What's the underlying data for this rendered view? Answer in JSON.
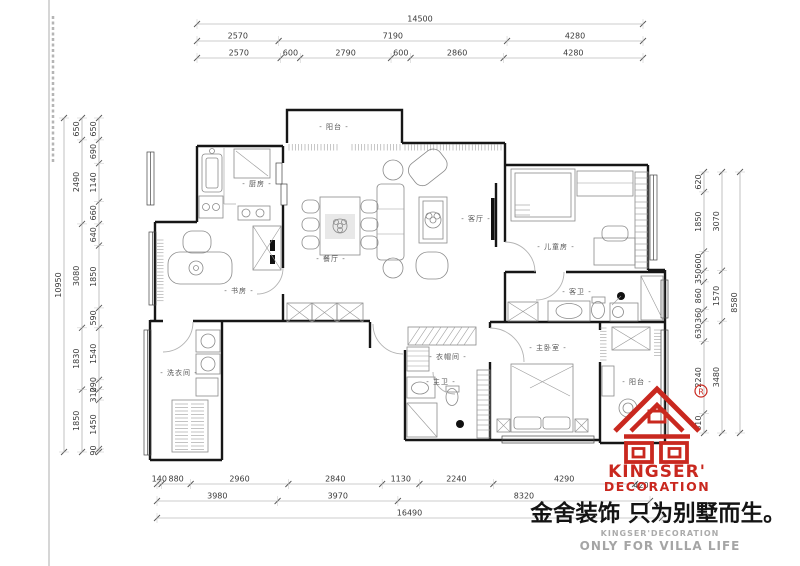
{
  "drawing": {
    "rooms": [
      {
        "label": "- 阳台 -",
        "x": 334,
        "y": 129
      },
      {
        "label": "- 厨房 -",
        "x": 257,
        "y": 186
      },
      {
        "label": "- 书房 -",
        "x": 239,
        "y": 293
      },
      {
        "label": "- 餐厅 -",
        "x": 331,
        "y": 261
      },
      {
        "label": "- 客厅 -",
        "x": 476,
        "y": 221
      },
      {
        "label": "- 儿童房 -",
        "x": 556,
        "y": 249
      },
      {
        "label": "- 客卫 -",
        "x": 577,
        "y": 294
      },
      {
        "label": "- 衣帽间 -",
        "x": 448,
        "y": 359
      },
      {
        "label": "- 主卫 -",
        "x": 441,
        "y": 384
      },
      {
        "label": "- 主卧室 -",
        "x": 548,
        "y": 350
      },
      {
        "label": "- 阳台 -",
        "x": 637,
        "y": 384
      },
      {
        "label": "- 洗衣间 -",
        "x": 179,
        "y": 375
      }
    ],
    "dimensions": {
      "top": {
        "total": [
          "14500"
        ],
        "tier2": [
          "2570",
          "7190",
          "4280"
        ],
        "tier3": [
          "2570",
          "600",
          "2790",
          "600",
          "2860",
          "4280"
        ]
      },
      "left": {
        "total": [
          "10950"
        ],
        "tier2": [
          "650",
          "2490",
          "3080",
          "1830",
          "1850"
        ],
        "tier3": [
          "650",
          "690",
          "1140",
          "660",
          "640",
          "1850",
          "590",
          "1540",
          "290",
          "310",
          "1450",
          "90"
        ]
      },
      "right": {
        "total": [
          "8580"
        ],
        "tier2": [
          "3070",
          "1570",
          "3480"
        ],
        "tier3": [
          "620",
          "1850",
          "600",
          "350",
          "860",
          "360",
          "630",
          "2240",
          "610"
        ]
      },
      "bottom": {
        "total": [
          "16490"
        ],
        "tier2": [
          "3980",
          "3970",
          "8320"
        ],
        "tier3": [
          "140",
          "880",
          "2960",
          "2840",
          "1130",
          "2240",
          "4290"
        ]
      },
      "ghost": "420"
    }
  },
  "logo": {
    "registered": "®",
    "brand_line1": "KINGSER'",
    "brand_line2": "DECORATION",
    "slogan": "金舍装饰 只为别墅而生。",
    "sub_line1": "KINGSER'DECORATION",
    "sub_line2": "ONLY FOR VILLA LIFE",
    "brand_red": "#c9281f",
    "sub_gray": "#a5a5a5"
  }
}
